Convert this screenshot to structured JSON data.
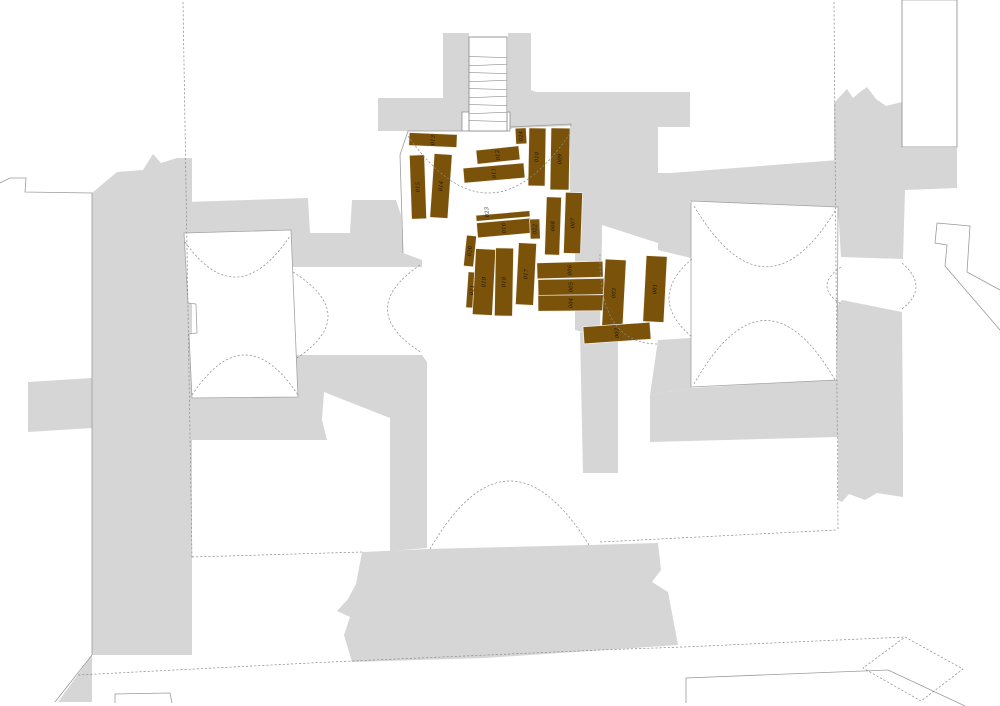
{
  "meta": {
    "width": 1000,
    "height": 706,
    "background": "#ffffff",
    "description": "Excavation floor plan with numbered wooden coffins/planks cluster"
  },
  "colors": {
    "mass_gray": "#d6d6d6",
    "room_fill": "#ffffff",
    "room_stroke": "#a3a3a3",
    "outline": "#9b9b9b",
    "dashed": "#8c8c8c",
    "stair_stroke": "#909090",
    "grave_fill": "#7a520a",
    "grave_stroke": "#f6f4ee",
    "label_color": "#161005"
  },
  "stairs": {
    "x": 469,
    "y": 37,
    "w": 38,
    "h": 94,
    "tread_ys": [
      57,
      65,
      73,
      81,
      89,
      97,
      105,
      113,
      121
    ],
    "landing": {
      "x": 462,
      "y": 112,
      "w": 48,
      "h": 19
    }
  },
  "gray_polygons": [
    {
      "name": "stair-block-west",
      "points": "378,98 443,98 443,33 469,33 469,131 378,131"
    },
    {
      "name": "stair-block-east-wall",
      "points": "508,33 531,33 531,90 536,92 602,92 602,240 572,240 572,126 513,128 508,131"
    },
    {
      "name": "northeast-mass",
      "points": "602,92 690,92 690,127 658,127 658,173 690,173 690,250 658,243 602,225"
    },
    {
      "name": "band-above-right-room",
      "points": "658,174 838,160 838,207 691,201 658,206"
    },
    {
      "name": "east-trunk-spiky",
      "points": "834,103 847,89 853,98 860,92 867,87 876,99 886,106 902,102 902,148 957,148 957,188 905,190 903,259 841,257 838,207 838,160 834,160"
    },
    {
      "name": "east-trunk-lower",
      "points": "842,300 902,312 903,440 903,497 877,493 865,500 849,494 842,502 838,500 838,305"
    },
    {
      "name": "right-room-south-band",
      "points": "650,395 691,388 837,380 840,380 840,437 650,442"
    },
    {
      "name": "right-room-west-jamb-upper",
      "points": "658,206 691,203 691,258 658,250"
    },
    {
      "name": "right-room-west-jamb-lower",
      "points": "658,340 691,338 691,388 650,395"
    },
    {
      "name": "nave-east-wall",
      "points": "575,238 602,240 600,330 583,332 575,330"
    },
    {
      "name": "nave-east-strip-south",
      "points": "580,332 618,340 618,473 583,473"
    },
    {
      "name": "west-mass-upper",
      "points": "186,202 308,198 310,233 350,233 352,200 396,200 401,215 403,253 422,260 422,267 186,267"
    },
    {
      "name": "west-mass-lower",
      "points": "186,355 422,355 427,362 427,548 390,551 390,418 324,392 322,420 327,440 193,440 186,438"
    },
    {
      "name": "west-slab",
      "points": "92,193 117,172 143,170 153,154 161,163 177,158 192,158 192,655 92,655"
    },
    {
      "name": "west-slab-foot",
      "points": "92,655 92,702 58,702"
    },
    {
      "name": "west-tab",
      "points": "28,382 92,378 92,428 28,432"
    },
    {
      "name": "bottom-center-blob",
      "points": "362,552 427,549 590,545 658,543 661,570 652,582 668,592 678,645 485,658 352,662 344,635 350,617 337,611 348,599 356,584"
    }
  ],
  "white_rooms": [
    {
      "name": "west-room",
      "points": "184,233 291,230 298,397 192,398 189,334 197,333 196,304 188,303"
    },
    {
      "name": "east-room",
      "points": "691,201 838,207 837,380 691,387"
    },
    {
      "name": "northeast-slot",
      "points": "902,0 957,0 957,147 902,147"
    }
  ],
  "outline_paths": [
    {
      "name": "northwest-building-edge",
      "d": "M0,183 L10,178 L26,178 L25,192 L92,193 L92,655 L55,702"
    },
    {
      "name": "northeast-slot-walls",
      "d": "M902,0 L902,147 L957,147 L957,0"
    },
    {
      "name": "east-key-shape-outer",
      "d": "M937,223 L970,226 L967,272 L1000,290"
    },
    {
      "name": "east-key-shape-inner",
      "d": "M937,223 L935,243 L947,245 L945,266 L1000,330"
    },
    {
      "name": "bottom-small-structure",
      "d": "M115,703 L115,694 L170,693 L172,703"
    },
    {
      "name": "bottom-retaining-line",
      "d": "M686,703 L686,678 L888,670 L965,706"
    },
    {
      "name": "graves-room-west-wall",
      "d": "M462,131 L408,131 L400,155 L403,253"
    },
    {
      "name": "graves-room-north-east-wall",
      "d": "M510,127 L571,124 L571,240"
    }
  ],
  "dashed_paths": [
    {
      "name": "long-dashed-west",
      "d": "M183,2 L192,558"
    },
    {
      "name": "long-dashed-east",
      "d": "M834,2 L838,530"
    },
    {
      "name": "dashed-southwest-room-bottom",
      "d": "M192,557 L362,552"
    },
    {
      "name": "dashed-southeast-room-bottom",
      "d": "M600,542 L837,530"
    },
    {
      "name": "dashed-bottom-diagonal",
      "d": "M78,675 L330,662 L600,650 L683,647 L905,637"
    },
    {
      "name": "dashed-bottom-diamond",
      "d": "M905,637 L963,669 L921,701 L863,668 Z"
    },
    {
      "name": "arc-west-room-north-vault",
      "d": "M185,242 Q237,315 290,236"
    },
    {
      "name": "arc-west-room-south-vault",
      "d": "M192,395 Q245,315 298,395"
    },
    {
      "name": "arc-west-room-east-door",
      "d": "M293,272 Q361,315 297,358"
    },
    {
      "name": "arc-west-corridor-door",
      "d": "M420,265 Q354,310 422,353"
    },
    {
      "name": "arc-graves-room-vault",
      "d": "M408,136 Q490,252 571,132"
    },
    {
      "name": "arc-east-channel-bend",
      "d": "M600,254 Q598,344 658,344"
    },
    {
      "name": "arc-east-room-west-door",
      "d": "M692,259 Q646,298 692,337"
    },
    {
      "name": "arc-east-room-north-vault",
      "d": "M694,206 Q765,325 835,211"
    },
    {
      "name": "arc-east-room-south-vault",
      "d": "M694,384 Q765,259 835,380"
    },
    {
      "name": "arc-east-passage-left",
      "d": "M841,267 Q813,286 841,304"
    },
    {
      "name": "arc-east-passage-right",
      "d": "M902,263 Q930,287 902,309"
    },
    {
      "name": "arc-nave-south-vault",
      "d": "M430,549 Q508,415 589,545"
    }
  ],
  "graves": [
    {
      "id": "013",
      "label": "013",
      "cx": 433,
      "cy": 140,
      "w": 48,
      "h": 13,
      "angle": 2.5
    },
    {
      "id": "015",
      "label": "015",
      "cx": 418,
      "cy": 187,
      "w": 15,
      "h": 64,
      "angle": -2
    },
    {
      "id": "014",
      "label": "014",
      "cx": 441,
      "cy": 186,
      "w": 18,
      "h": 64,
      "angle": 4
    },
    {
      "id": "012",
      "label": "012",
      "cx": 498,
      "cy": 155,
      "w": 43,
      "h": 14,
      "angle": -6
    },
    {
      "id": "011",
      "label": "011",
      "cx": 494,
      "cy": 173,
      "w": 61,
      "h": 15,
      "angle": -5
    },
    {
      "id": "024",
      "label": "024",
      "cx": 521,
      "cy": 136,
      "w": 11,
      "h": 16,
      "angle": -3
    },
    {
      "id": "010",
      "label": "010",
      "cx": 537,
      "cy": 157,
      "w": 17,
      "h": 58,
      "angle": 1
    },
    {
      "id": "009",
      "label": "009",
      "cx": 560,
      "cy": 159,
      "w": 19,
      "h": 62,
      "angle": 1
    },
    {
      "id": "023",
      "label": "023",
      "cx": 503,
      "cy": 216,
      "w": 54,
      "h": 6,
      "angle": -5,
      "lx": 487,
      "ly": 212
    },
    {
      "id": "016",
      "label": "016",
      "cx": 504,
      "cy": 228,
      "w": 54,
      "h": 15,
      "angle": -5
    },
    {
      "id": "022",
      "label": "022",
      "cx": 535,
      "cy": 229,
      "w": 10,
      "h": 20,
      "angle": -2
    },
    {
      "id": "008",
      "label": "008",
      "cx": 553,
      "cy": 226,
      "w": 15,
      "h": 58,
      "angle": 2
    },
    {
      "id": "007",
      "label": "007",
      "cx": 573,
      "cy": 223,
      "w": 17,
      "h": 61,
      "angle": 2
    },
    {
      "id": "020",
      "label": "020",
      "cx": 470,
      "cy": 251,
      "w": 10,
      "h": 31,
      "angle": 6
    },
    {
      "id": "021",
      "label": "021",
      "cx": 472,
      "cy": 290,
      "w": 10,
      "h": 36,
      "angle": 4
    },
    {
      "id": "019",
      "label": "019",
      "cx": 484,
      "cy": 282,
      "w": 20,
      "h": 66,
      "angle": 3
    },
    {
      "id": "018",
      "label": "018",
      "cx": 504,
      "cy": 282,
      "w": 18,
      "h": 68,
      "angle": 1
    },
    {
      "id": "017",
      "label": "017",
      "cx": 526,
      "cy": 274,
      "w": 18,
      "h": 62,
      "angle": 3
    },
    {
      "id": "006",
      "label": "006",
      "cx": 570,
      "cy": 270,
      "w": 66,
      "h": 16,
      "angle": -1.5
    },
    {
      "id": "005",
      "label": "005",
      "cx": 571,
      "cy": 287,
      "w": 66,
      "h": 16,
      "angle": -1
    },
    {
      "id": "004",
      "label": "004",
      "cx": 571,
      "cy": 303,
      "w": 66,
      "h": 16,
      "angle": -0.5
    },
    {
      "id": "003",
      "label": "003",
      "cx": 614,
      "cy": 293,
      "w": 21,
      "h": 67,
      "angle": 3
    },
    {
      "id": "001",
      "label": "001",
      "cx": 655,
      "cy": 289,
      "w": 21,
      "h": 66,
      "angle": 3
    },
    {
      "id": "002",
      "label": "002",
      "cx": 617,
      "cy": 333,
      "w": 67,
      "h": 17,
      "angle": -4
    }
  ]
}
